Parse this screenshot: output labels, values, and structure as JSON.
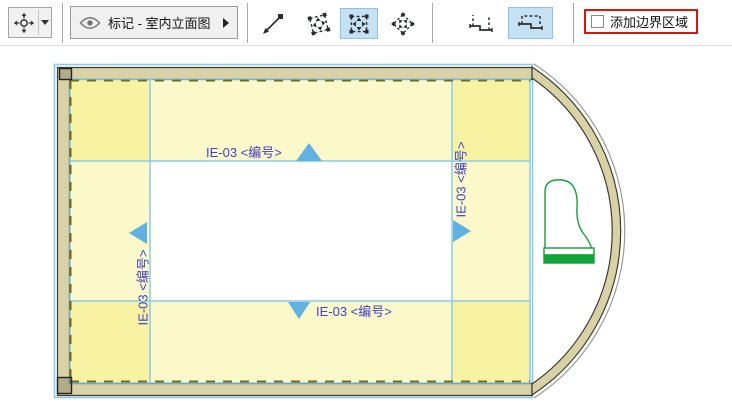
{
  "window": {
    "width": 732,
    "height": 408
  },
  "toolbar": {
    "move_tool": {
      "icon": "move-crosshair-icon",
      "has_dropdown": true
    },
    "marker_dropdown": {
      "icon": "eye-icon",
      "label": "标记 - 室内立面图",
      "expander": "right-arrow-icon"
    },
    "geometry_tools": [
      {
        "icon": "single-line-icon",
        "selected": false
      },
      {
        "icon": "rotated-marquee-icon",
        "selected": false
      },
      {
        "icon": "rectangular-marquee-icon",
        "selected": true
      },
      {
        "icon": "diamond-marquee-icon",
        "selected": false
      }
    ],
    "chain_tools": [
      {
        "icon": "open-polyline-icon",
        "selected": false
      },
      {
        "icon": "closed-polyline-icon",
        "selected": true
      }
    ],
    "boundary_checkbox": {
      "label": "添加边界区域",
      "checked": false,
      "highlighted": true,
      "highlight_color": "#de1408"
    }
  },
  "drawing": {
    "markers": {
      "top": {
        "label": "IE-03 <编号>",
        "direction": "up"
      },
      "right": {
        "label": "IE-03 <编号>",
        "direction": "right"
      },
      "bottom": {
        "label": "IE-03 <编号>",
        "direction": "down"
      },
      "left": {
        "label": "IE-03 <编号>",
        "direction": "left"
      }
    },
    "furniture": "grand-piano",
    "colors": {
      "wall_fill": "#d9d2a6",
      "wall_outline": "#3c3c30",
      "boundary_line": "#88ccec",
      "zone_fill": "rgba(242,230,60,0.28)",
      "dash_line": "#6f6a1c",
      "marker_triangle": "#61b1e2",
      "marker_text": "#3f3fd0",
      "furniture_green": "#12a038"
    }
  }
}
